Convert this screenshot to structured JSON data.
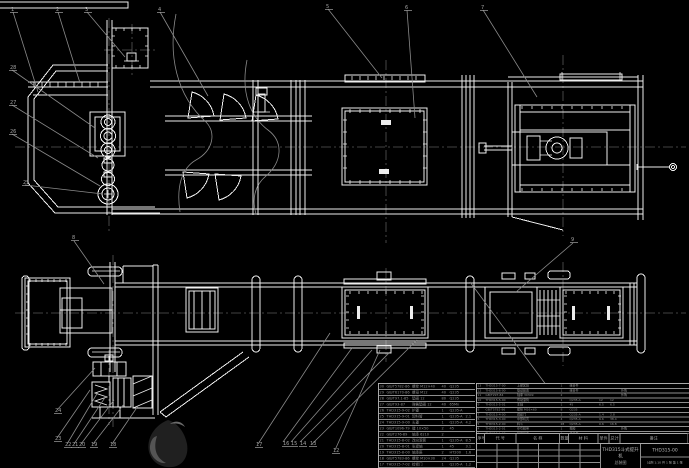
{
  "colors": {
    "background": "#000000",
    "line": "#ededed",
    "leader": "#8a8a8a",
    "centerline": "#585858",
    "table_text": "#8f8f8f"
  },
  "title_block": {
    "product": "THD315斗式提升机",
    "doc_type": "总装图",
    "drawing_no": "THD315-00",
    "info_line": "比例 1:10  共 1 张  第 1 张"
  },
  "bom": {
    "headers": [
      "序号",
      "代  号",
      "名  称",
      "数量",
      "材  料",
      "单件",
      "总计",
      "备注"
    ],
    "left_rows": [
      [
        "30",
        "GB/T5782-86",
        "螺栓 M12×40",
        "40",
        "Q235",
        "",
        ""
      ],
      [
        "29",
        "GB/T6170-86",
        "螺母 M12",
        "40",
        "Q235",
        "",
        ""
      ],
      [
        "28",
        "GB/T97.1-85",
        "垫圈 12",
        "80",
        "Q235",
        "",
        ""
      ],
      [
        "27",
        "GB/T93-87",
        "弹簧垫圈 12",
        "40",
        "65Mn",
        "",
        ""
      ],
      [
        "26",
        "THD315-9-02",
        "护罩",
        "1",
        "Q235-A",
        "",
        ""
      ],
      [
        "25",
        "THD315-9-01",
        "卸料管",
        "1",
        "Q235-A",
        "2.1",
        ""
      ],
      [
        "24",
        "THD315-9-00",
        "头罩",
        "1",
        "Q235-A",
        "4.2",
        ""
      ],
      [
        "23",
        "GB/T1096-79",
        "键 10×50",
        "2",
        "45",
        "",
        ""
      ],
      [
        "22",
        "GB/T276-89",
        "轴承 6210",
        "2",
        "",
        "",
        ""
      ],
      [
        "21",
        "THD315-8-02",
        "改向滚筒",
        "1",
        "Q235-A",
        "8.5",
        ""
      ],
      [
        "20",
        "THD315-8-01",
        "张紧轴",
        "1",
        "45",
        "3.1",
        ""
      ],
      [
        "19",
        "THD315-8-00",
        "轴承座",
        "2",
        "HT200",
        "1.6",
        ""
      ],
      [
        "18",
        "GB/T5783-86",
        "螺栓 M10×30",
        "24",
        "Q235",
        "",
        ""
      ],
      [
        "17",
        "THD315-7-02",
        "检修门",
        "1",
        "Q235-A",
        "1.2",
        ""
      ],
      [
        "16",
        "THD315-7-01",
        "底座",
        "1",
        "Q235-A",
        "6.4",
        ""
      ],
      [
        "15",
        "GB/T117-86",
        "销 8×35",
        "4",
        "35",
        "",
        ""
      ],
      [
        "14",
        "THD315-6-01",
        "联轴器",
        "1",
        "HT200",
        "2.8",
        ""
      ]
    ],
    "right_rows": [
      [
        "13",
        "THD315-7-00",
        "上部区段",
        "1",
        "组合件",
        "",
        "",
        ""
      ],
      [
        "12",
        "THD315-6-00",
        "驱动装置",
        "1",
        "组合件",
        "",
        "",
        "外购"
      ],
      [
        "11",
        "GB/T297-84",
        "轴承 30309",
        "2",
        "",
        "",
        "",
        "外购"
      ],
      [
        "10",
        "THD315-5-00",
        "传动滚筒",
        "1",
        "Q235-A",
        "12",
        "12",
        ""
      ],
      [
        "9",
        "THD315-5-01",
        "主轴",
        "1",
        "45",
        "6.5",
        "6.5",
        ""
      ],
      [
        "8",
        "GB/T5782-86",
        "螺栓 M16×60",
        "8",
        "Q235",
        "",
        "",
        ""
      ],
      [
        "7",
        "THD315-4-00",
        "观察门",
        "2",
        "Q235-A",
        "1.4",
        "2.8",
        ""
      ],
      [
        "6",
        "THD315-3-00",
        "中部机壳",
        "4",
        "Q235-A",
        "9.6",
        "38.4",
        ""
      ],
      [
        "5",
        "THD315-2-00",
        "料斗",
        "28",
        "Q235-A",
        "0.6",
        "16.8",
        ""
      ],
      [
        "4",
        "THD315-2-01",
        "牵引胶带",
        "1",
        "橡胶",
        "",
        "",
        "外购"
      ],
      [
        "3",
        "THD315-1-00",
        "张紧装置",
        "1",
        "组合件",
        "",
        "",
        ""
      ],
      [
        "2",
        "THD315-0-01",
        "进料斗",
        "1",
        "Q235-A",
        "3.2",
        "3.2",
        ""
      ],
      [
        "1",
        "THD315-0-00",
        "下部区段",
        "1",
        "组合件",
        "",
        "",
        ""
      ]
    ]
  },
  "balloons": [
    {
      "x": 11,
      "y": 11,
      "label": "1"
    },
    {
      "x": 56,
      "y": 11,
      "label": "2"
    },
    {
      "x": 85,
      "y": 11,
      "label": "3"
    },
    {
      "x": 158,
      "y": 11,
      "label": "4"
    },
    {
      "x": 326,
      "y": 8,
      "label": "5"
    },
    {
      "x": 405,
      "y": 9,
      "label": "6"
    },
    {
      "x": 481,
      "y": 9,
      "label": "7"
    },
    {
      "x": 10,
      "y": 69,
      "label": "28"
    },
    {
      "x": 10,
      "y": 104,
      "label": "27"
    },
    {
      "x": 10,
      "y": 133,
      "label": "26"
    },
    {
      "x": 23,
      "y": 184,
      "label": "25"
    },
    {
      "x": 72,
      "y": 239,
      "label": "8"
    },
    {
      "x": 571,
      "y": 241,
      "label": "9"
    },
    {
      "x": 55,
      "y": 412,
      "label": "24"
    },
    {
      "x": 55,
      "y": 440,
      "label": "23"
    },
    {
      "x": 65,
      "y": 446,
      "label": "22"
    },
    {
      "x": 72,
      "y": 446,
      "label": "21"
    },
    {
      "x": 79,
      "y": 446,
      "label": "20"
    },
    {
      "x": 91,
      "y": 446,
      "label": "19"
    },
    {
      "x": 110,
      "y": 446,
      "label": "18"
    },
    {
      "x": 256,
      "y": 446,
      "label": "17"
    },
    {
      "x": 283,
      "y": 445,
      "label": "16"
    },
    {
      "x": 291,
      "y": 445,
      "label": "15"
    },
    {
      "x": 300,
      "y": 445,
      "label": "14"
    },
    {
      "x": 310,
      "y": 445,
      "label": "13"
    },
    {
      "x": 333,
      "y": 452,
      "label": "12"
    }
  ]
}
